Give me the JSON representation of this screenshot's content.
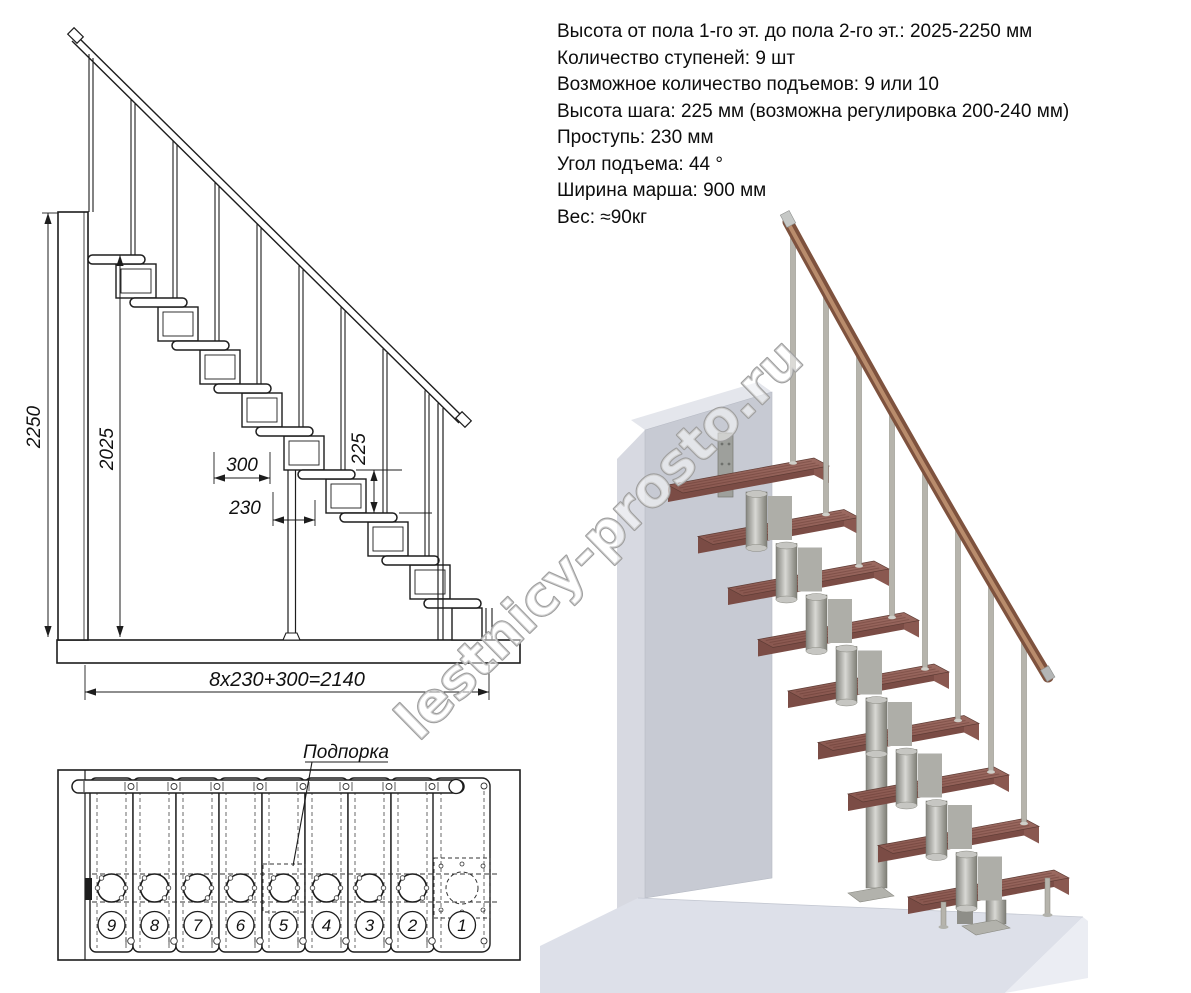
{
  "specs": {
    "lines": [
      "Высота от пола 1-го эт. до пола 2-го эт.: 2025-2250 мм",
      "Количество ступеней: 9 шт",
      "Возможное количество подъемов: 9 или 10",
      "Высота шага: 225 мм (возможна регулировка 200-240 мм)",
      "Проступь: 230 мм",
      "Угол подъема: 44 °",
      "Ширина марша: 900 мм",
      "Вес: ≈90кг"
    ]
  },
  "side_view": {
    "dim_total_height": "2250",
    "dim_clear_height": "2025",
    "dim_top_tread": "300",
    "dim_run": "230",
    "dim_rise": "225",
    "dim_total_run": "8x230+300=2140"
  },
  "plan_view": {
    "support_label": "Подпорка",
    "step_numbers": [
      "9",
      "8",
      "7",
      "6",
      "5",
      "4",
      "3",
      "2",
      "1"
    ]
  },
  "watermark": "lestnicy-prosto.ru",
  "colors": {
    "line": "#1d1d1d",
    "wood_top": "#93605a",
    "wood_front": "#7b4c45",
    "rail_wood": "#7e523e",
    "steel": "#9c9c96",
    "wall_front": "#c7cad3",
    "floor_top": "#dde0e9",
    "watermark_stroke": "#9e9e9e"
  }
}
